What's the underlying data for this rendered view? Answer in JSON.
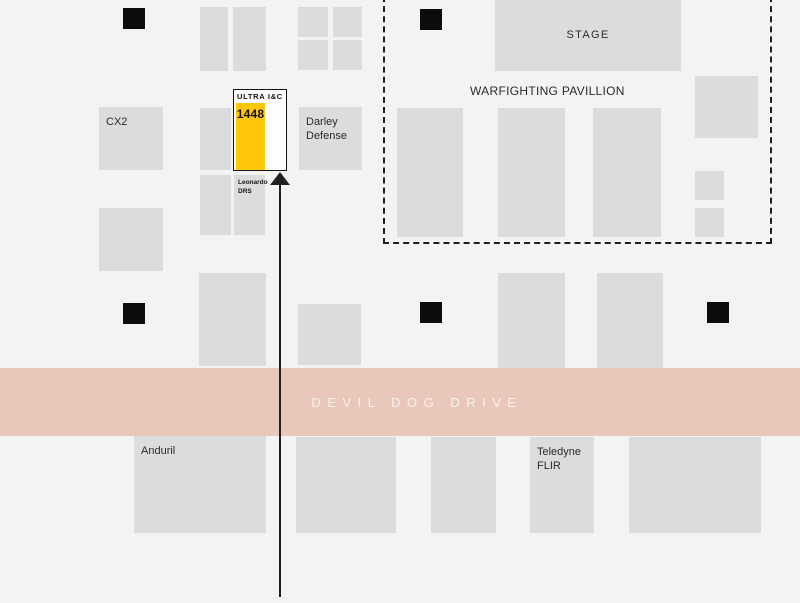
{
  "page": {
    "background": "#f3f3f4",
    "booth_fill": "#dcdcde",
    "pillar_fill": "#0c0c0c",
    "label_color": "#2b2b2b",
    "line_color": "#1f1f1f"
  },
  "road": {
    "label": "DEVIL DOG DRIVE",
    "fill": "#e9c7bb",
    "label_color": "#f8f1ed"
  },
  "pavilion": {
    "label": "WARFIGHTING PAVILLION"
  },
  "highlight_booth": {
    "brand": "ULTRA I&C",
    "number": "1448",
    "fill": "#ffc60a",
    "border_color": "#141414"
  },
  "labeled_booths": [
    {
      "id": "stage",
      "label": "STAGE",
      "x": 495,
      "y": 0,
      "w": 186,
      "h": 71,
      "align": "center"
    },
    {
      "id": "cx2",
      "label": "CX2",
      "x": 99,
      "y": 107,
      "w": 64,
      "h": 63
    },
    {
      "id": "darley-defense",
      "label": "Darley Defense",
      "x": 299,
      "y": 107,
      "w": 63,
      "h": 63
    },
    {
      "id": "leonardo-drs",
      "label": "Leonardo DRS",
      "x": 234,
      "y": 175,
      "w": 31,
      "h": 60,
      "small": true
    },
    {
      "id": "anduril",
      "label": "Anduril",
      "x": 134,
      "y": 436,
      "w": 132,
      "h": 97
    },
    {
      "id": "teledyne-flir",
      "label": "Teledyne FLIR",
      "x": 530,
      "y": 437,
      "w": 64,
      "h": 96
    }
  ],
  "unlabeled_booths": [
    [
      200,
      7,
      28,
      64
    ],
    [
      233,
      7,
      33,
      64
    ],
    [
      298,
      7,
      30,
      30
    ],
    [
      333,
      7,
      29,
      30
    ],
    [
      298,
      40,
      30,
      30
    ],
    [
      333,
      40,
      29,
      30
    ],
    [
      200,
      108,
      31,
      62
    ],
    [
      200,
      175,
      31,
      60
    ],
    [
      99,
      208,
      64,
      63
    ],
    [
      199,
      273,
      67,
      93
    ],
    [
      298,
      304,
      63,
      61
    ],
    [
      498,
      273,
      67,
      95
    ],
    [
      597,
      273,
      66,
      95
    ],
    [
      397,
      108,
      66,
      129
    ],
    [
      498,
      108,
      67,
      129
    ],
    [
      593,
      108,
      68,
      129
    ],
    [
      695,
      76,
      63,
      62
    ],
    [
      695,
      171,
      29,
      29
    ],
    [
      695,
      208,
      29,
      29
    ],
    [
      296,
      437,
      100,
      96
    ],
    [
      431,
      437,
      65,
      96
    ],
    [
      629,
      437,
      132,
      96
    ]
  ],
  "pillars": [
    [
      123,
      8
    ],
    [
      420,
      9
    ],
    [
      123,
      303
    ],
    [
      420,
      302
    ],
    [
      707,
      302
    ]
  ]
}
